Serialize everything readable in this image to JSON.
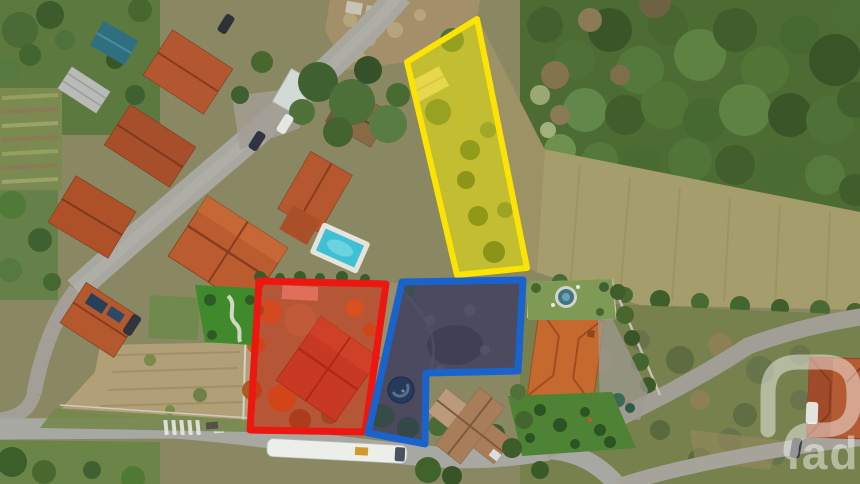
{
  "watermark": {
    "text": "iad",
    "color": "#ffffff",
    "opacity": "0.45"
  },
  "overlays": {
    "yellow": {
      "stroke": "#fbe304",
      "fill": "rgba(250,225,0,0.42)",
      "stroke_width": "6"
    },
    "red": {
      "stroke": "#ec1710",
      "fill": "rgba(233,25,14,0.45)",
      "stroke_width": "7"
    },
    "blue": {
      "stroke": "#1a63cd",
      "fill": "rgba(50,58,128,0.32)",
      "stroke_width": "7"
    }
  },
  "scene": {
    "ground": "#8a8862",
    "road": "#a8a8a1",
    "forest": "#4c6c34",
    "field": "#a59e6c",
    "roof": "#b5582f",
    "pool": "#3ec1d4"
  }
}
